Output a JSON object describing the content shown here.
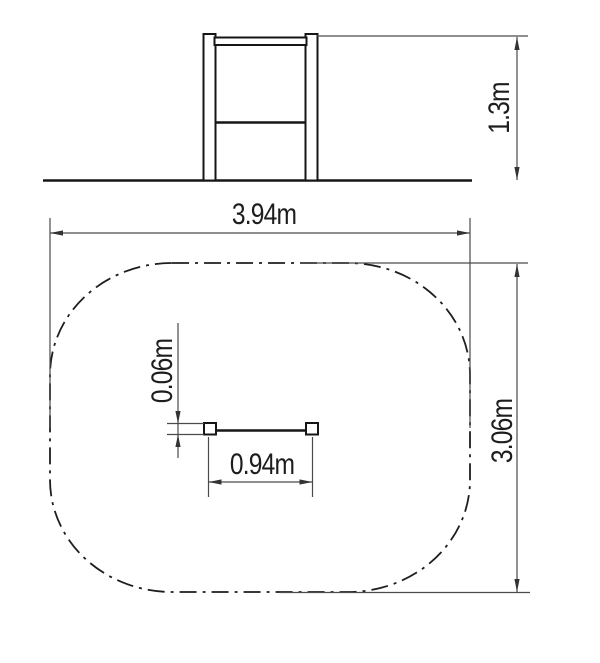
{
  "colors": {
    "background": "#ffffff",
    "structure_line": "#161616",
    "dimension_line": "#4a4a4a",
    "safety_zone_line": "#1e1e1e"
  },
  "dimensions": {
    "structure_height": {
      "label": "1.3m",
      "value_m": 1.3
    },
    "zone_width": {
      "label": "3.94m",
      "value_m": 3.94
    },
    "zone_depth": {
      "label": "3.06m",
      "value_m": 3.06
    },
    "bar_length": {
      "label": "0.94m",
      "value_m": 0.94
    },
    "post_thickness": {
      "label": "0.06m",
      "value_m": 0.06
    }
  }
}
